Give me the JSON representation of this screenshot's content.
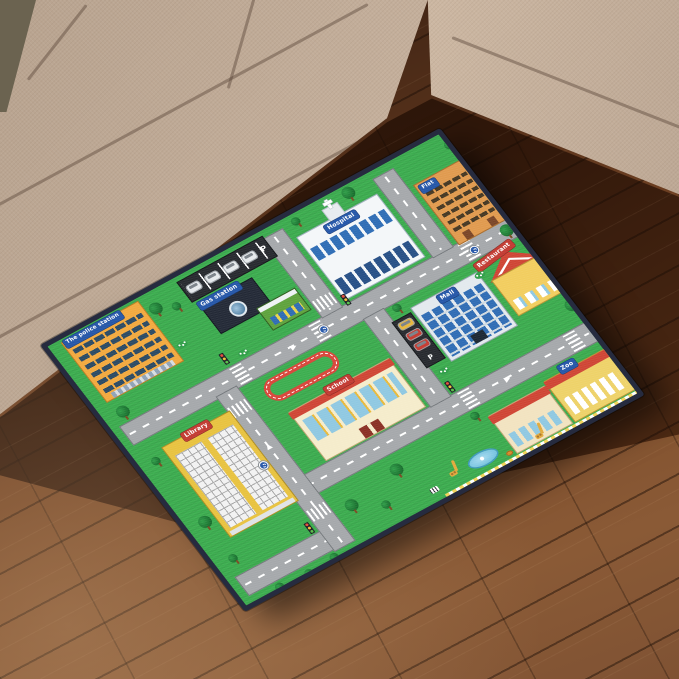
{
  "scene": {
    "subject": "kids-city-road-play-mat-product-photo",
    "sofa_color": "#c0ab97",
    "floor_dark": "#2e1a0f",
    "floor_light": "#8a5a36"
  },
  "mat": {
    "palette": {
      "grass_green": "#3cae4f",
      "road_gray": "#a5a8ab",
      "border_navy": "#262b3f",
      "sign_blue": "#2456a8",
      "sign_red": "#c23a31",
      "track_red": "#d8453a",
      "parking_black": "#26292e"
    },
    "buildings": {
      "police": {
        "label": "The police station"
      },
      "gas": {
        "label": "Gas station"
      },
      "hospital": {
        "label": "Hospital"
      },
      "flat": {
        "label": "Flat"
      },
      "mall": {
        "label": "Mall"
      },
      "restaurant": {
        "label": "Restaurant"
      },
      "school": {
        "label": "School"
      },
      "library": {
        "label": "Library"
      },
      "zoo": {
        "label": "Zoo"
      }
    },
    "markings": {
      "parking": "P"
    }
  }
}
